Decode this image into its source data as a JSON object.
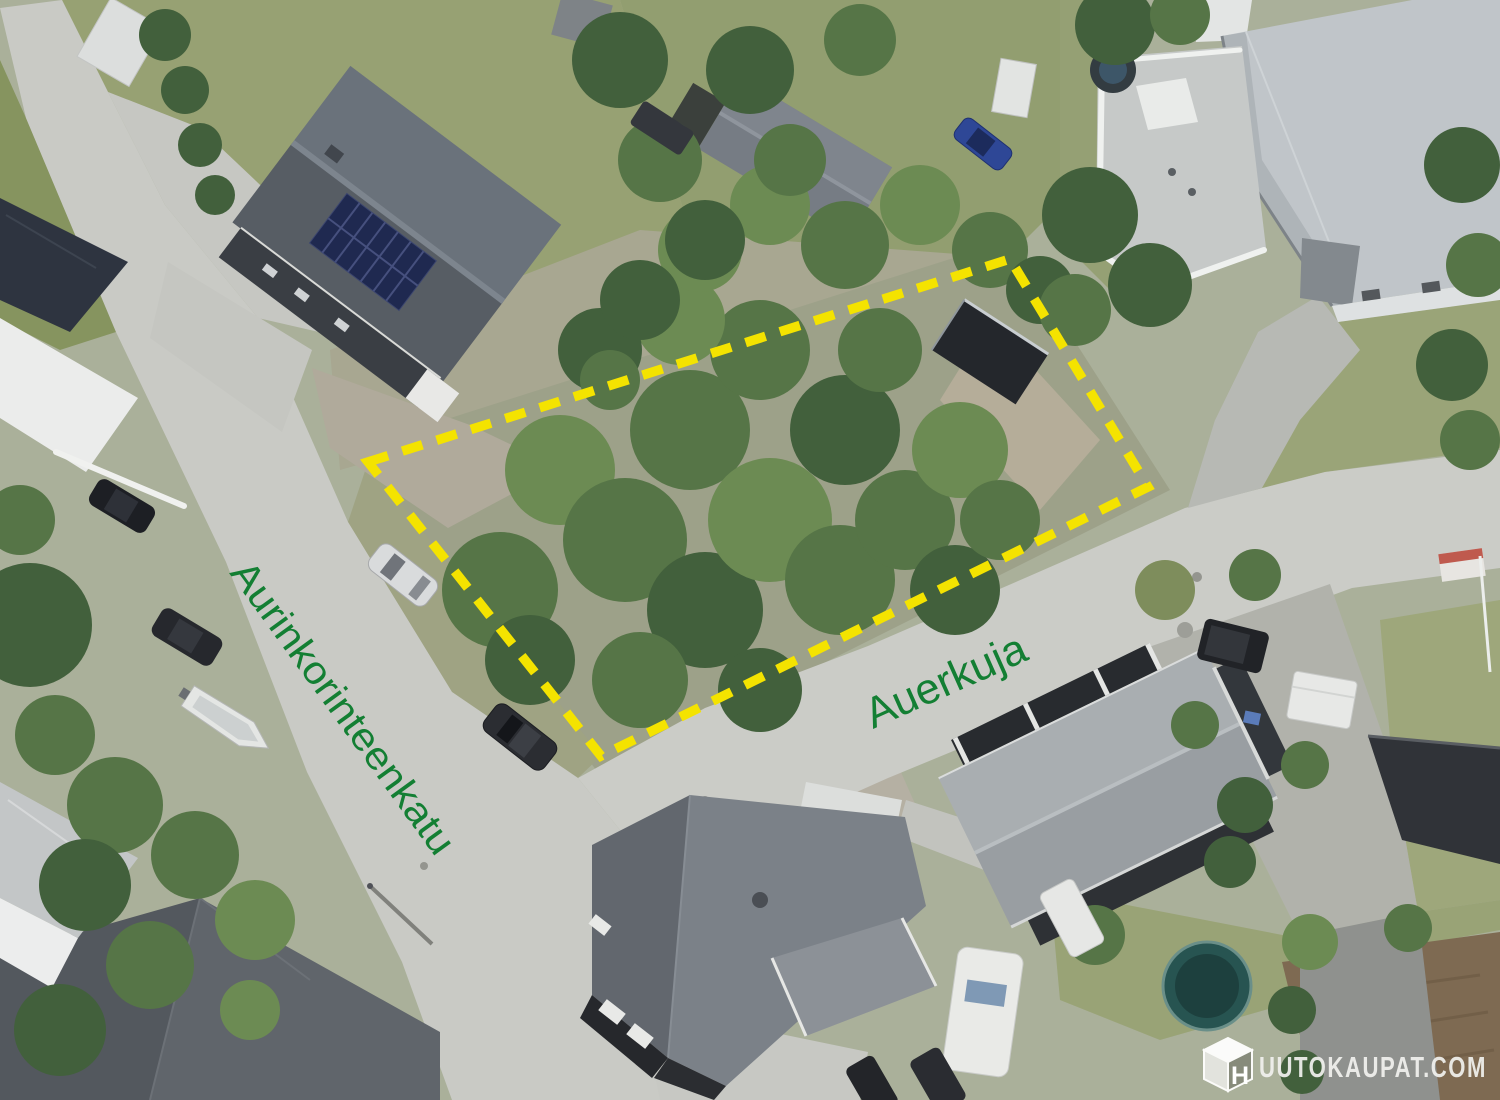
{
  "scene": {
    "type": "aerial-photo",
    "plot_outline_points": "368,462 1010,259 1148,487 601,756"
  },
  "street_labels": [
    {
      "label": "Aurinkorinteenkatu"
    },
    {
      "label": "Auerkuja"
    }
  ],
  "watermark": {
    "site_name": "HUUTOKAUPAT.COM",
    "cube_letter": "H",
    "text_after_cube": "UUTOKAUPAT.COM"
  },
  "colors": {
    "boundary": "#F4E300",
    "street_label": "#137F33",
    "watermark": "#F2F2EF"
  }
}
